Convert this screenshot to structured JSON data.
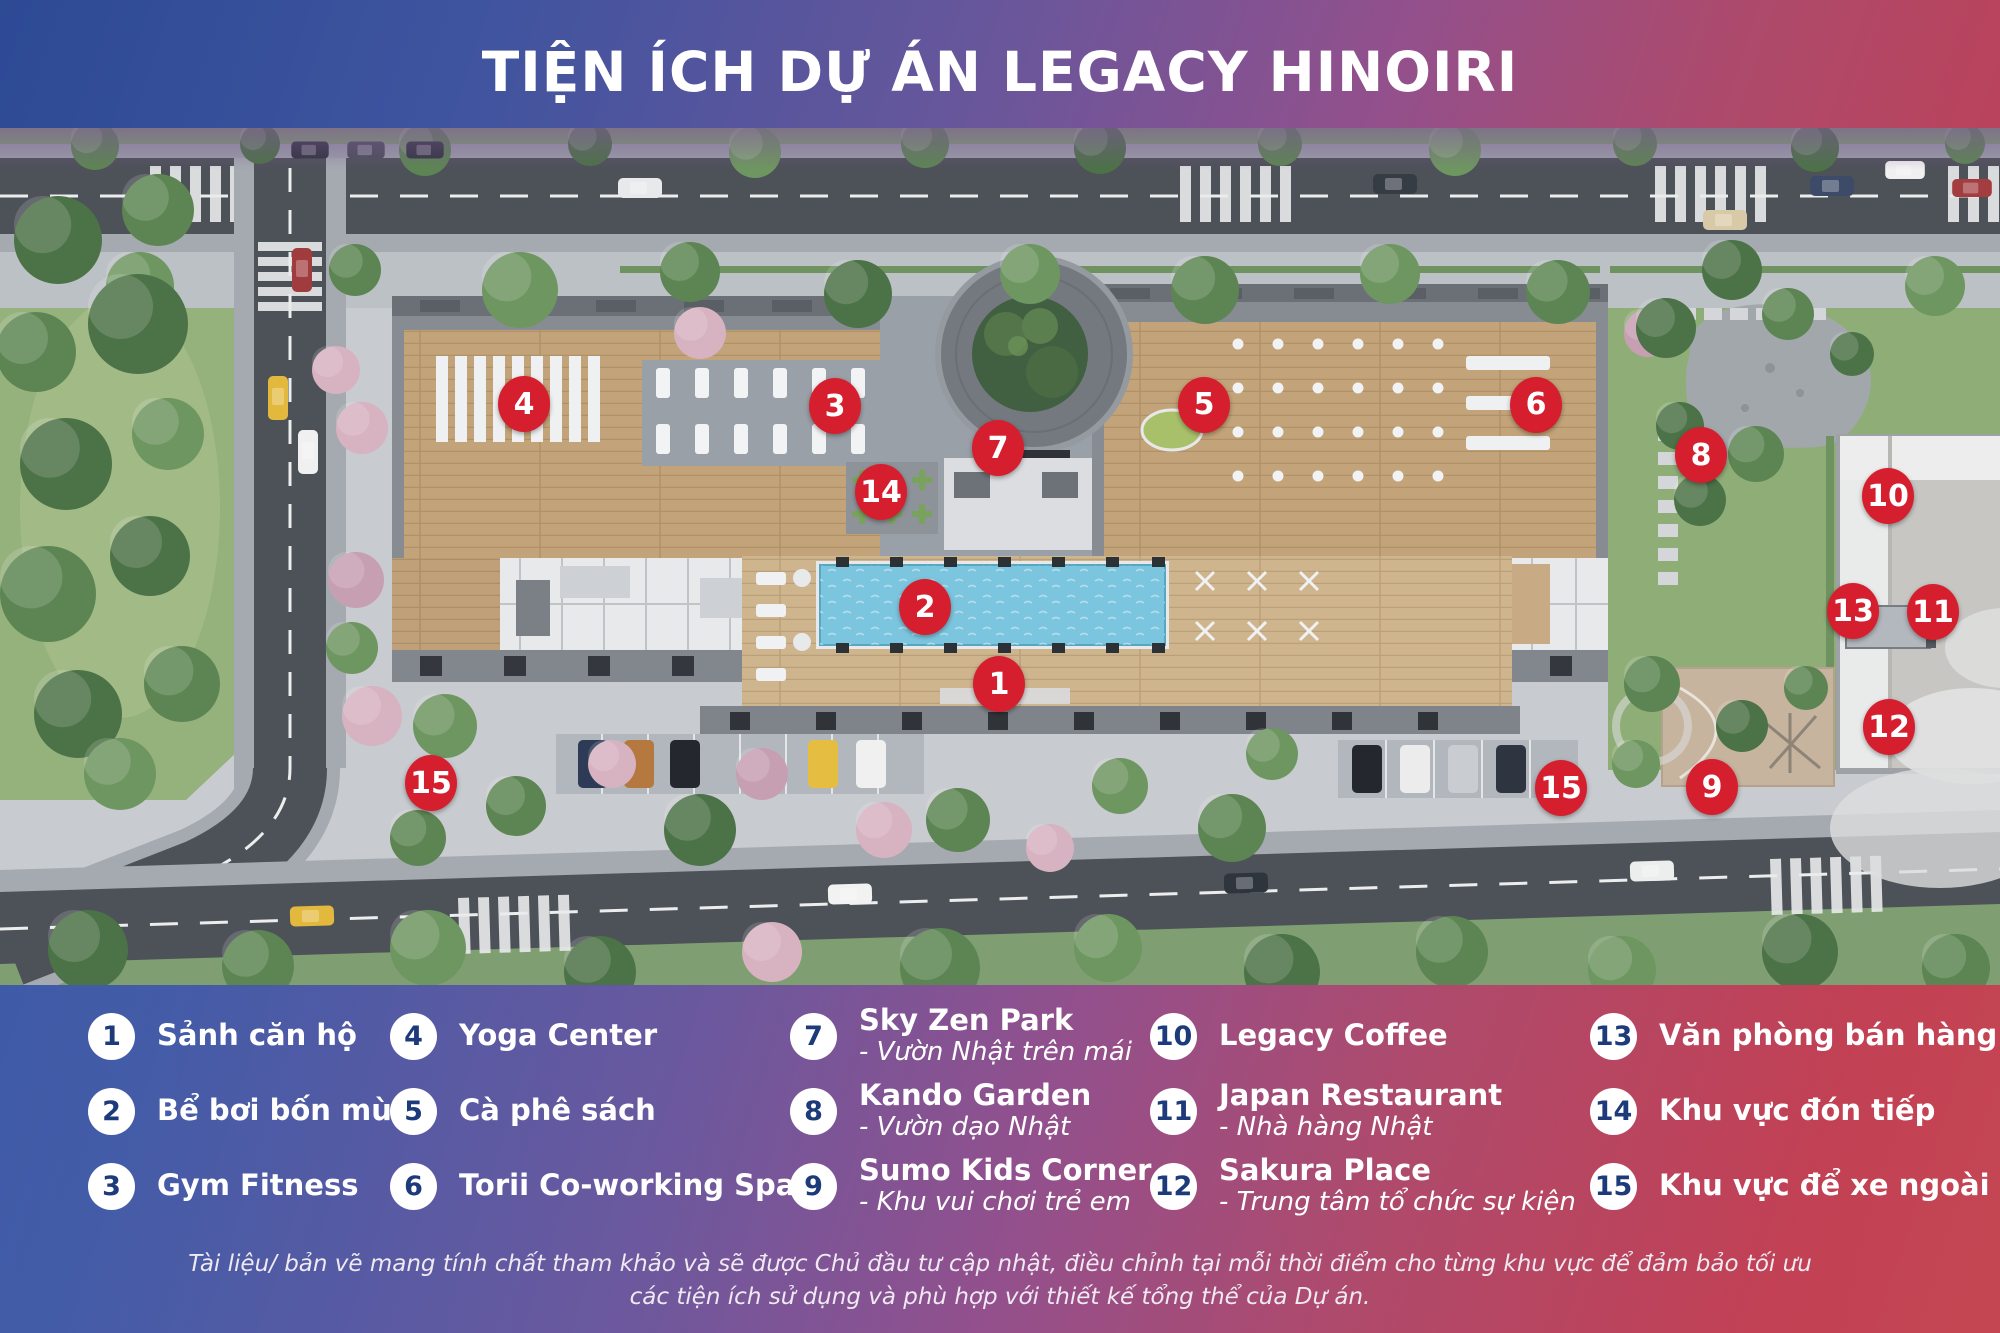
{
  "title": "TIỆN ÍCH DỰ ÁN LEGACY HINOIRI",
  "map": {
    "markers": [
      {
        "n": "1",
        "x": 999,
        "y": 556
      },
      {
        "n": "2",
        "x": 925,
        "y": 479
      },
      {
        "n": "3",
        "x": 835,
        "y": 278
      },
      {
        "n": "4",
        "x": 524,
        "y": 276
      },
      {
        "n": "5",
        "x": 1204,
        "y": 277
      },
      {
        "n": "6",
        "x": 1536,
        "y": 277
      },
      {
        "n": "7",
        "x": 998,
        "y": 320
      },
      {
        "n": "8",
        "x": 1701,
        "y": 327
      },
      {
        "n": "9",
        "x": 1712,
        "y": 659
      },
      {
        "n": "10",
        "x": 1888,
        "y": 368
      },
      {
        "n": "11",
        "x": 1933,
        "y": 484
      },
      {
        "n": "12",
        "x": 1889,
        "y": 599
      },
      {
        "n": "13",
        "x": 1853,
        "y": 483
      },
      {
        "n": "14",
        "x": 881,
        "y": 364
      },
      {
        "n": "15",
        "x": 431,
        "y": 655
      },
      {
        "n": "15",
        "x": 1561,
        "y": 660
      }
    ]
  },
  "legend": {
    "columns": [
      {
        "items": [
          {
            "n": "1",
            "label": "Sảnh căn hộ"
          },
          {
            "n": "2",
            "label": "Bể bơi bốn mùa"
          },
          {
            "n": "3",
            "label": "Gym Fitness"
          }
        ]
      },
      {
        "items": [
          {
            "n": "4",
            "label": "Yoga Center"
          },
          {
            "n": "5",
            "label": "Cà phê sách"
          },
          {
            "n": "6",
            "label": "Torii Co-working Space"
          }
        ]
      },
      {
        "items": [
          {
            "n": "7",
            "label": "Sky Zen Park",
            "sub": "- Vườn Nhật trên mái"
          },
          {
            "n": "8",
            "label": "Kando Garden",
            "sub": "- Vườn dạo Nhật"
          },
          {
            "n": "9",
            "label": "Sumo Kids Corner",
            "sub": "- Khu vui chơi trẻ em"
          }
        ]
      },
      {
        "items": [
          {
            "n": "10",
            "label": "Legacy Coffee"
          },
          {
            "n": "11",
            "label": "Japan Restaurant",
            "sub": "- Nhà hàng Nhật"
          },
          {
            "n": "12",
            "label": "Sakura Place",
            "sub": "- Trung tâm tổ chức sự kiện"
          }
        ]
      },
      {
        "items": [
          {
            "n": "13",
            "label": "Văn phòng bán hàng"
          },
          {
            "n": "14",
            "label": "Khu vực đón tiếp"
          },
          {
            "n": "15",
            "label": "Khu vực để xe ngoài trời"
          }
        ]
      }
    ]
  },
  "disclaimer": {
    "line1": "Tài liệu/ bản vẽ mang tính chất tham khảo và sẽ được Chủ đầu tư cập nhật, điều chỉnh tại mỗi thời điểm cho từng khu vực để đảm bảo tối ưu",
    "line2": "các tiện ích sử dụng và phù hợp với thiết kế tổng thể của Dự án."
  },
  "colors": {
    "marker_red": "#d61f2e",
    "legend_number_navy": "#1d3b7a",
    "gradient_blue": "#2d4a95",
    "gradient_red": "#c24652",
    "pool_blue": "#7cc5de"
  }
}
